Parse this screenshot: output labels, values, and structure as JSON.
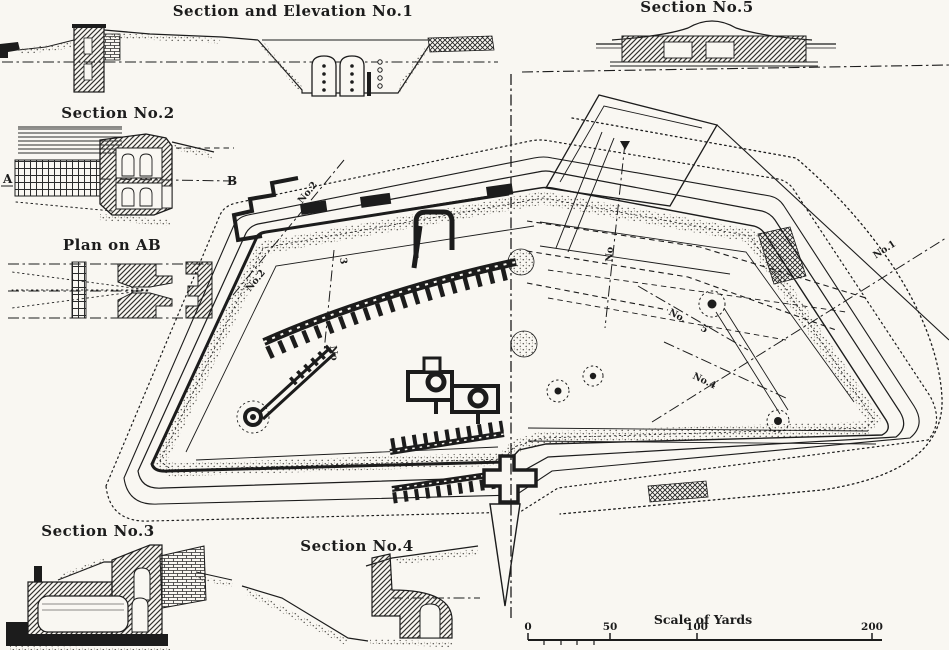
{
  "palette": {
    "paper": "#f9f7f2",
    "ink": "#1c1c1c",
    "stipple": "#5d5b56"
  },
  "titles": {
    "sec1": "Section and Elevation No.1",
    "sec2": "Section No.2",
    "planAB": "Plan on AB",
    "sec3": "Section No.3",
    "sec4": "Section No.4",
    "sec5": "Section No.5"
  },
  "sec2_labels": {
    "a": "A",
    "b": "B"
  },
  "plan_labels": {
    "no2_upper": "No.2",
    "no2_lower": "No.2",
    "no3_digit": "3",
    "no3_prefix": "No",
    "no5_vert": "No",
    "no5_prefix": "No.",
    "no5_digit": "5",
    "no4": "No.4",
    "no1": "No.1"
  },
  "scale": {
    "title": "Scale of Yards",
    "tick0": "0",
    "tick50": "50",
    "tick100": "100",
    "tick200": "200"
  }
}
